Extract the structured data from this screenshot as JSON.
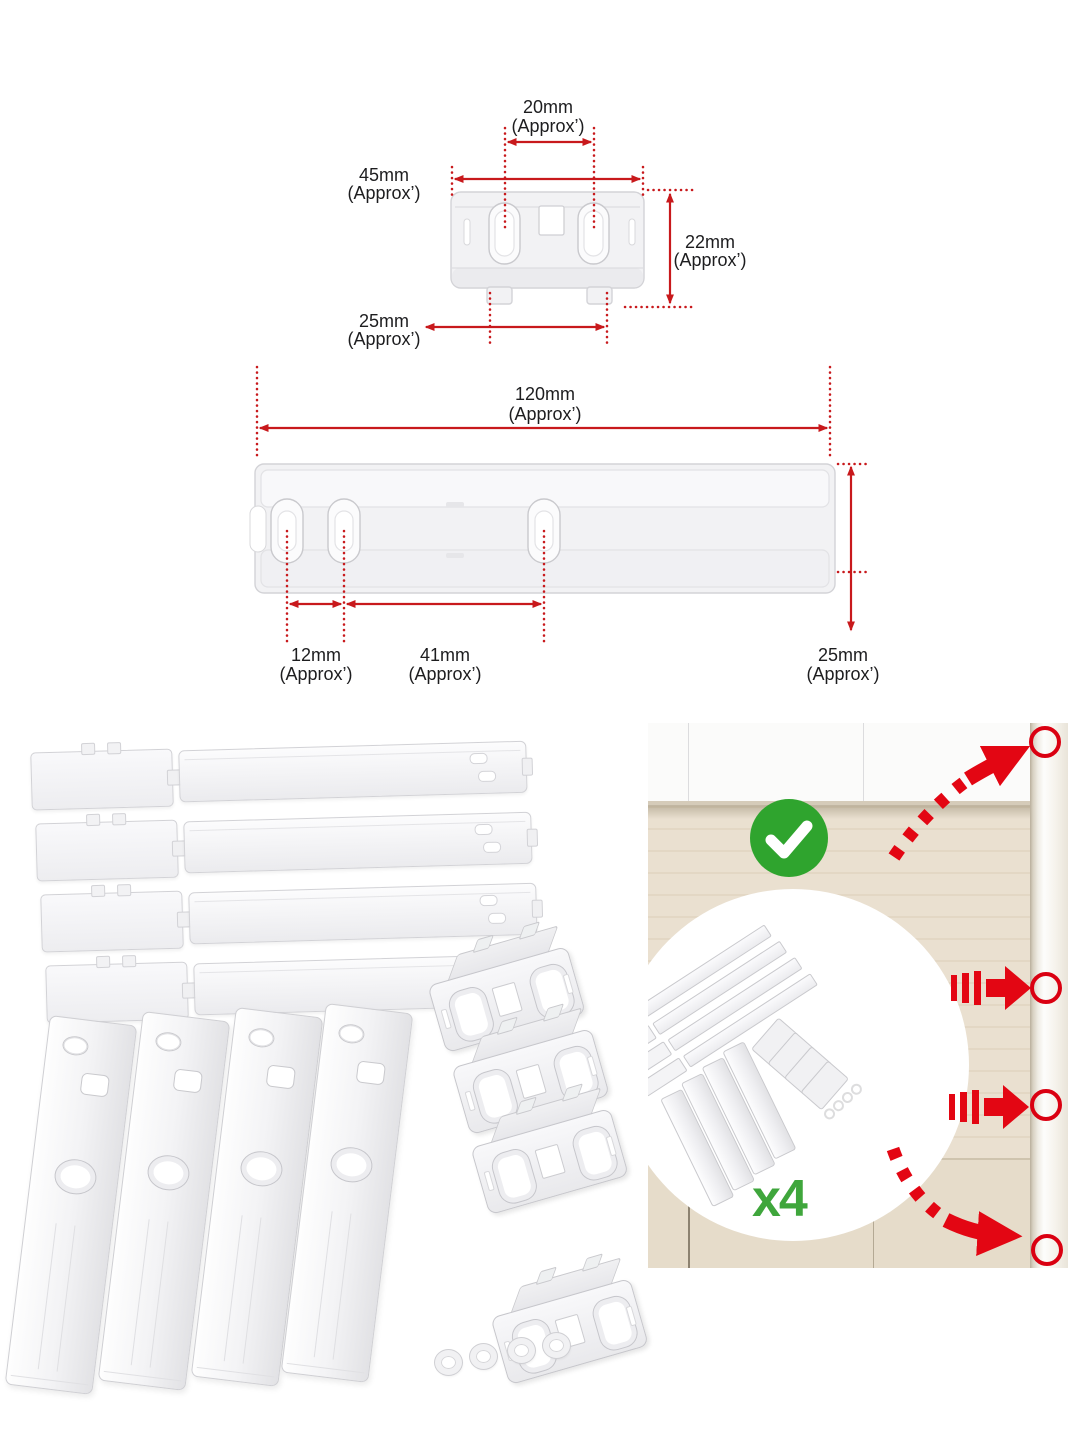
{
  "bracket_diagram": {
    "slot_pitch": {
      "value": "20mm",
      "approx": "(Approx’)"
    },
    "width": {
      "value": "45mm",
      "approx": "(Approx’)"
    },
    "height": {
      "value": "22mm",
      "approx": "(Approx’)"
    },
    "tab_pitch": {
      "value": "25mm",
      "approx": "(Approx’)"
    }
  },
  "rail_diagram": {
    "length": {
      "value": "120mm",
      "approx": "(Approx’)"
    },
    "hole_gap_small": {
      "value": "12mm",
      "approx": "(Approx’)"
    },
    "hole_gap_large": {
      "value": "41mm",
      "approx": "(Approx’)"
    },
    "height": {
      "value": "25mm",
      "approx": "(Approx’)"
    }
  },
  "install_photo": {
    "quantity_label": "x4",
    "check_icon": "green-check",
    "arrow_icon": "red-curved-arrow",
    "target_icon": "red-circle-marker"
  },
  "colors": {
    "dimension_red": "#c8191c",
    "arrow_red": "#e30613",
    "check_green": "#2fa42e",
    "quantity_green": "#3fa63c",
    "wall_beige": "#eae0d0"
  }
}
